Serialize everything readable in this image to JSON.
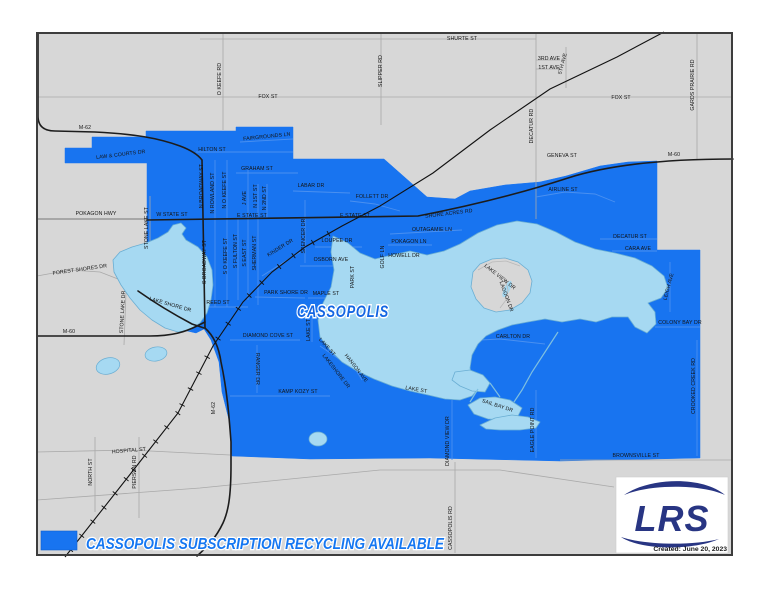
{
  "map": {
    "city_label": "CASSOPOLIS",
    "theme": {
      "page_bg": "#ffffff",
      "map_bg": "#d7d7d7",
      "border": "#3d3d3d",
      "service_blue": "#1874f0",
      "lake_fill": "#a6d9f2",
      "lake_stroke": "#6aaed3",
      "road_major": "#1c1c1c",
      "road_minor_gray": "#a9a9a9",
      "road_minor_blue": "#4a90f0",
      "railroad": "#111111",
      "label_color": "#141414"
    },
    "street_labels": [
      {
        "t": "SHURTE ST",
        "x": 462,
        "y": 40,
        "r": 0
      },
      {
        "t": "O KEEFE RD",
        "x": 221,
        "y": 79,
        "r": -90
      },
      {
        "t": "FOX ST",
        "x": 268,
        "y": 98,
        "r": 0
      },
      {
        "t": "SLIPPER RD",
        "x": 382,
        "y": 71,
        "r": -90
      },
      {
        "t": "3RD AVE",
        "x": 549,
        "y": 60,
        "r": 0
      },
      {
        "t": "1ST AVE",
        "x": 549,
        "y": 69,
        "r": 0
      },
      {
        "t": "5TH AVE",
        "x": 564,
        "y": 64,
        "r": -75
      },
      {
        "t": "DECATUR RD",
        "x": 533,
        "y": 126,
        "r": -90
      },
      {
        "t": "FOX ST",
        "x": 621,
        "y": 99,
        "r": 0
      },
      {
        "t": "GARDS PRAIRIE RD",
        "x": 694,
        "y": 85,
        "r": -90
      },
      {
        "t": "GENEVA ST",
        "x": 562,
        "y": 157,
        "r": 0
      },
      {
        "t": "M-60",
        "x": 674,
        "y": 156,
        "r": 0
      },
      {
        "t": "M-62",
        "x": 85,
        "y": 129,
        "r": 0
      },
      {
        "t": "POKAGON HWY",
        "x": 96,
        "y": 215,
        "r": 0
      },
      {
        "t": "W STATE ST",
        "x": 172,
        "y": 216,
        "r": 0
      },
      {
        "t": "FOREST SHORES DR",
        "x": 80,
        "y": 271,
        "r": -8
      },
      {
        "t": "STONE LAKE ST",
        "x": 148,
        "y": 228,
        "r": -90
      },
      {
        "t": "STONE LAKE DR",
        "x": 124,
        "y": 312,
        "r": -87
      },
      {
        "t": "M-60",
        "x": 69,
        "y": 333,
        "r": 0
      },
      {
        "t": "LAKE SHORE DR",
        "x": 170,
        "y": 306,
        "r": 16
      },
      {
        "t": "NORTH ST",
        "x": 92,
        "y": 472,
        "r": -90
      },
      {
        "t": "PIERSON RD",
        "x": 136,
        "y": 472,
        "r": -90
      },
      {
        "t": "HOSPITAL ST",
        "x": 129,
        "y": 452,
        "r": -5
      },
      {
        "t": "M-62",
        "x": 215,
        "y": 408,
        "r": -90
      },
      {
        "t": "CASSOPOLIS RD",
        "x": 452,
        "y": 528,
        "r": -90
      },
      {
        "t": "DIAMOND VIEW DR",
        "x": 449,
        "y": 441,
        "r": -90
      },
      {
        "t": "EAGLE POINT RD",
        "x": 534,
        "y": 430,
        "r": -90
      },
      {
        "t": "CROOKED CREEK RD",
        "x": 695,
        "y": 386,
        "r": -90
      },
      {
        "t": "BROWNSVILLE ST",
        "x": 636,
        "y": 457,
        "r": 0
      },
      {
        "t": "LAW & COURTS DR",
        "x": 121,
        "y": 156,
        "r": -7
      },
      {
        "t": "HILTON ST",
        "x": 212,
        "y": 151,
        "r": 0
      },
      {
        "t": "FAIRGROUNDS LN",
        "x": 267,
        "y": 138,
        "r": -6
      },
      {
        "t": "GRAHAM ST",
        "x": 257,
        "y": 170,
        "r": 0
      },
      {
        "t": "LABAR DR",
        "x": 311,
        "y": 187,
        "r": 0
      },
      {
        "t": "FOLLETT DR",
        "x": 372,
        "y": 198,
        "r": 0
      },
      {
        "t": "N BROADWAY ST",
        "x": 203,
        "y": 186,
        "r": -90
      },
      {
        "t": "N ROWLAND ST",
        "x": 214,
        "y": 193,
        "r": -90
      },
      {
        "t": "N O KEEFE ST",
        "x": 226,
        "y": 190,
        "r": -90
      },
      {
        "t": "J AVE",
        "x": 246,
        "y": 198,
        "r": -90
      },
      {
        "t": "N 1ST ST",
        "x": 257,
        "y": 196,
        "r": -90
      },
      {
        "t": "N 2ND ST",
        "x": 266,
        "y": 198,
        "r": -90
      },
      {
        "t": "E STATE ST",
        "x": 252,
        "y": 217,
        "r": 0
      },
      {
        "t": "E STATE ST",
        "x": 355,
        "y": 217,
        "r": 0
      },
      {
        "t": "SHORE ACRES RD",
        "x": 449,
        "y": 215,
        "r": -7
      },
      {
        "t": "S BROADWAY ST",
        "x": 206,
        "y": 262,
        "r": -90
      },
      {
        "t": "S O KEEFE ST",
        "x": 227,
        "y": 256,
        "r": -90
      },
      {
        "t": "S FULTON ST",
        "x": 237,
        "y": 251,
        "r": -90
      },
      {
        "t": "S EAST ST",
        "x": 246,
        "y": 253,
        "r": -90
      },
      {
        "t": "SHERMAN ST",
        "x": 256,
        "y": 253,
        "r": -90
      },
      {
        "t": "REED ST",
        "x": 218,
        "y": 304,
        "r": 0
      },
      {
        "t": "KINDER DR",
        "x": 281,
        "y": 249,
        "r": -32
      },
      {
        "t": "SPENCER DR",
        "x": 305,
        "y": 236,
        "r": -90
      },
      {
        "t": "LOUPEE DR",
        "x": 337,
        "y": 242,
        "r": 0
      },
      {
        "t": "OSBORN AVE",
        "x": 331,
        "y": 261,
        "r": 0
      },
      {
        "t": "PARK SHORE DR",
        "x": 286,
        "y": 294,
        "r": 0
      },
      {
        "t": "MAPLE ST",
        "x": 326,
        "y": 295,
        "r": 0
      },
      {
        "t": "PARK ST",
        "x": 354,
        "y": 277,
        "r": -90
      },
      {
        "t": "OUTAGAMIE LN",
        "x": 432,
        "y": 231,
        "r": 0
      },
      {
        "t": "POKAGON LN",
        "x": 409,
        "y": 243,
        "r": 0
      },
      {
        "t": "HOWELL DR",
        "x": 404,
        "y": 257,
        "r": 0
      },
      {
        "t": "GOLF LN",
        "x": 384,
        "y": 257,
        "r": -90
      },
      {
        "t": "AIRLINE ST",
        "x": 563,
        "y": 191,
        "r": 0
      },
      {
        "t": "DECATUR ST",
        "x": 630,
        "y": 238,
        "r": 0
      },
      {
        "t": "CARA AVE",
        "x": 638,
        "y": 250,
        "r": 0
      },
      {
        "t": "LEIGH AVE",
        "x": 670,
        "y": 287,
        "r": -75
      },
      {
        "t": "COLONY BAY DR",
        "x": 680,
        "y": 324,
        "r": 0
      },
      {
        "t": "CARLTON DR",
        "x": 513,
        "y": 338,
        "r": 0
      },
      {
        "t": "LAKE VIEW DR",
        "x": 499,
        "y": 278,
        "r": 38
      },
      {
        "t": "LAGOON DR",
        "x": 505,
        "y": 297,
        "r": 70
      },
      {
        "t": "DIAMOND COVE ST",
        "x": 268,
        "y": 337,
        "r": 0
      },
      {
        "t": "RANGER DR",
        "x": 256,
        "y": 369,
        "r": 90
      },
      {
        "t": "KAMP KOZY ST",
        "x": 298,
        "y": 393,
        "r": 0
      },
      {
        "t": "LAKE ST",
        "x": 310,
        "y": 330,
        "r": -90
      },
      {
        "t": "LAKE ST",
        "x": 326,
        "y": 348,
        "r": 48
      },
      {
        "t": "LAKESHORE DR",
        "x": 335,
        "y": 372,
        "r": 52
      },
      {
        "t": "HANSON AVE",
        "x": 355,
        "y": 369,
        "r": 52
      },
      {
        "t": "LAKE ST",
        "x": 416,
        "y": 391,
        "r": 10
      },
      {
        "t": "SAIL BAY DR",
        "x": 497,
        "y": 407,
        "r": 18
      }
    ]
  },
  "legend": {
    "label": "CASSOPOLIS SUBSCRIPTION RECYCLING AVAILABLE",
    "swatch_color": "#1874f0"
  },
  "logo": {
    "text": "LRS",
    "credit": "Created: June 20, 2023"
  }
}
